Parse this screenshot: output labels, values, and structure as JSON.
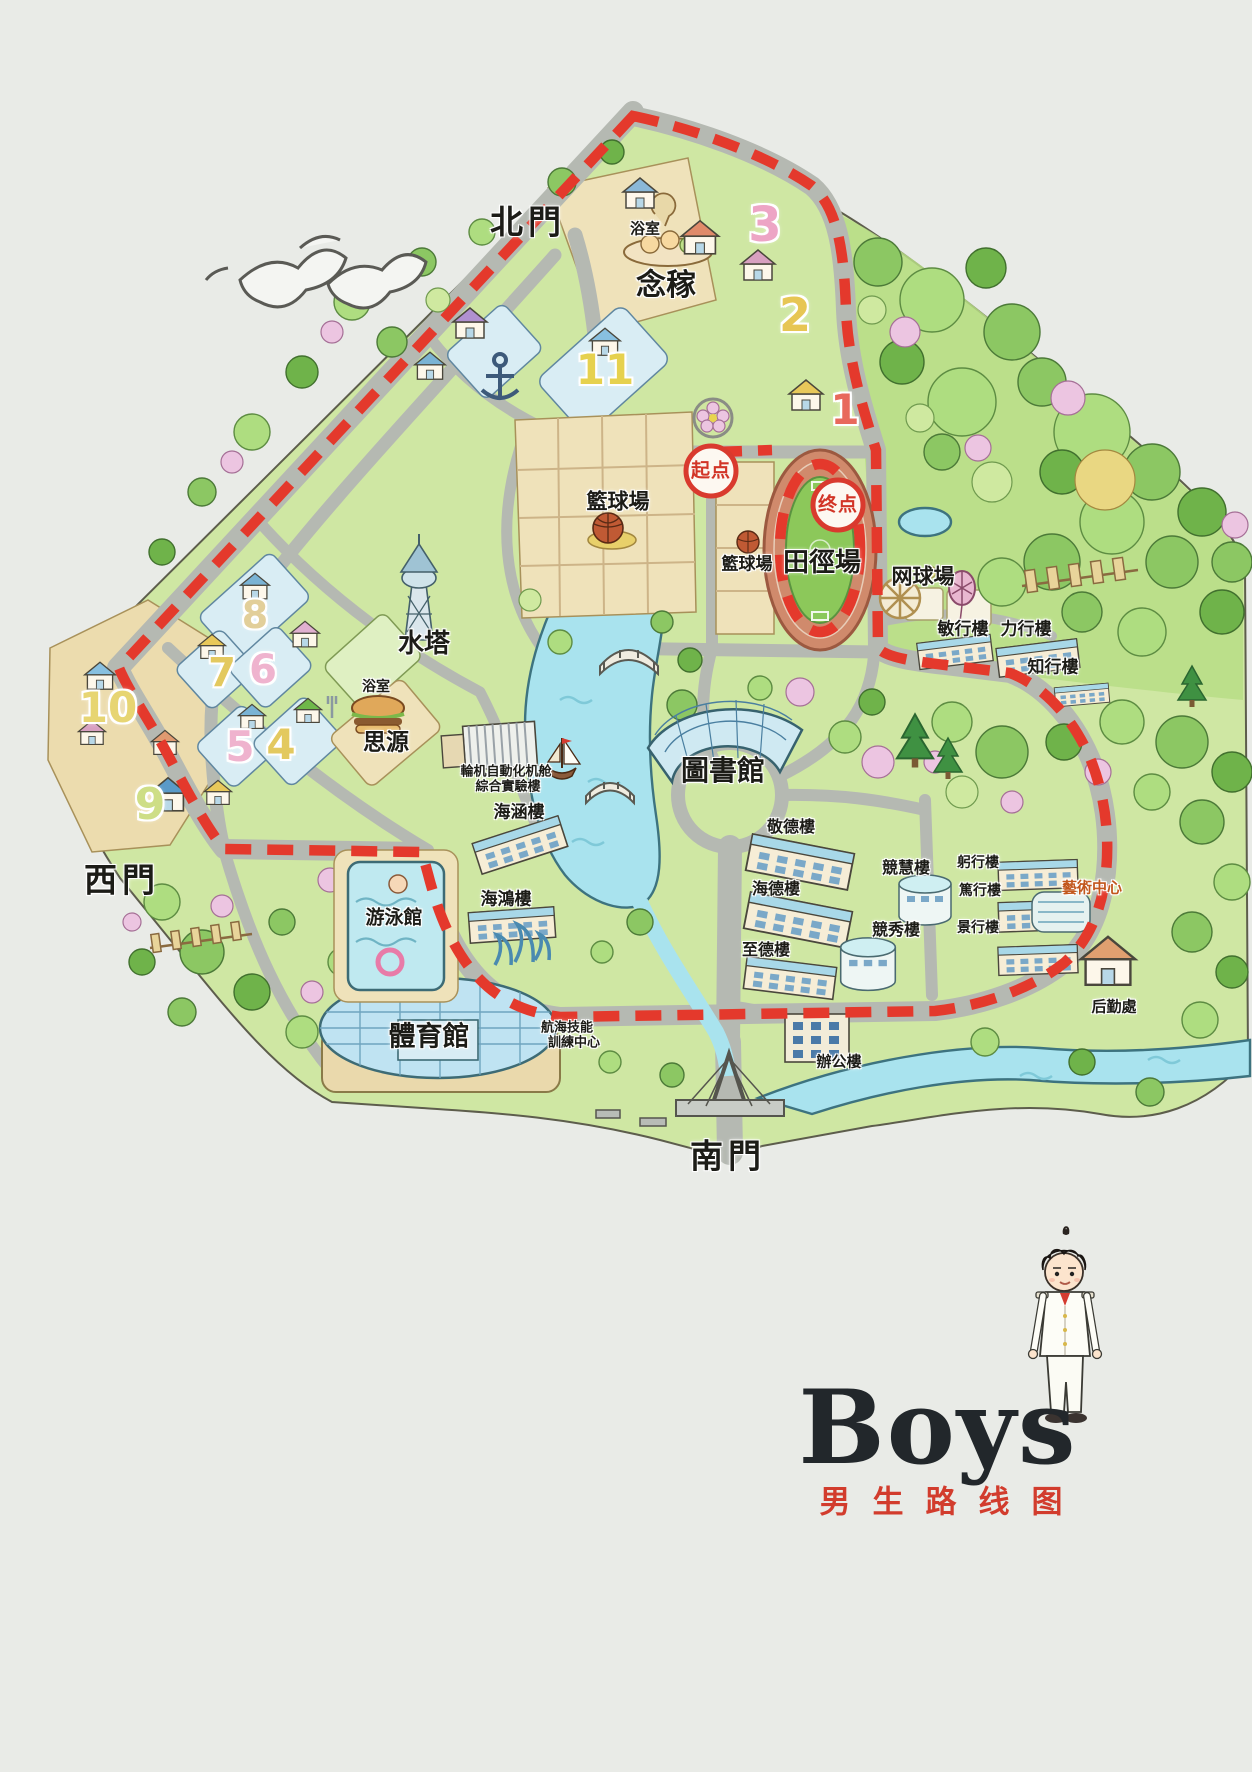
{
  "poster": {
    "logo": "Boys",
    "route_title": "男生路线图"
  },
  "gates": {
    "north": "北門",
    "west": "西門",
    "south": "南門"
  },
  "route": {
    "start": "起点",
    "end": "终点",
    "color": "#e4392c"
  },
  "places": {
    "bath_north": "浴室",
    "nianjia": "念稼",
    "basketball_1": "籃球場",
    "basketball_2": "籃球場",
    "track_field": "田徑場",
    "tennis": "网球場",
    "minxing": "敏行樓",
    "lixing": "力行樓",
    "zhixing": "知行樓",
    "water_tower": "水塔",
    "bath_west": "浴室",
    "siyuan": "思源",
    "marine_lab_1": "輪机自動化机舱",
    "marine_lab_2": "綜合實驗樓",
    "haihan": "海涵樓",
    "haihong": "海鴻樓",
    "swimming": "游泳館",
    "library": "圖書館",
    "jingde": "敬德樓",
    "haide": "海德樓",
    "zhide": "至德樓",
    "jinghui": "競慧樓",
    "jingxiu": "競秀樓",
    "gongxing": "躬行樓",
    "duxing": "篤行樓",
    "jingxing": "景行樓",
    "art_center": "藝術中心",
    "logistics": "后勤處",
    "gym": "體育館",
    "nav_center_1": "航海技能",
    "nav_center_2": "訓練中心",
    "office": "辦公樓"
  },
  "dorm_numbers": {
    "d1": "1",
    "d2": "2",
    "d3": "3",
    "d4": "4",
    "d5": "5",
    "d6": "6",
    "d7": "7",
    "d8": "8",
    "d9": "9",
    "d10": "10",
    "d11": "11"
  },
  "colors": {
    "route_red": "#e4392c",
    "accent_red": "#d23c2d",
    "water": "#a9e3ee",
    "road": "#b5b9b2",
    "grass": "#cfe7a3"
  }
}
